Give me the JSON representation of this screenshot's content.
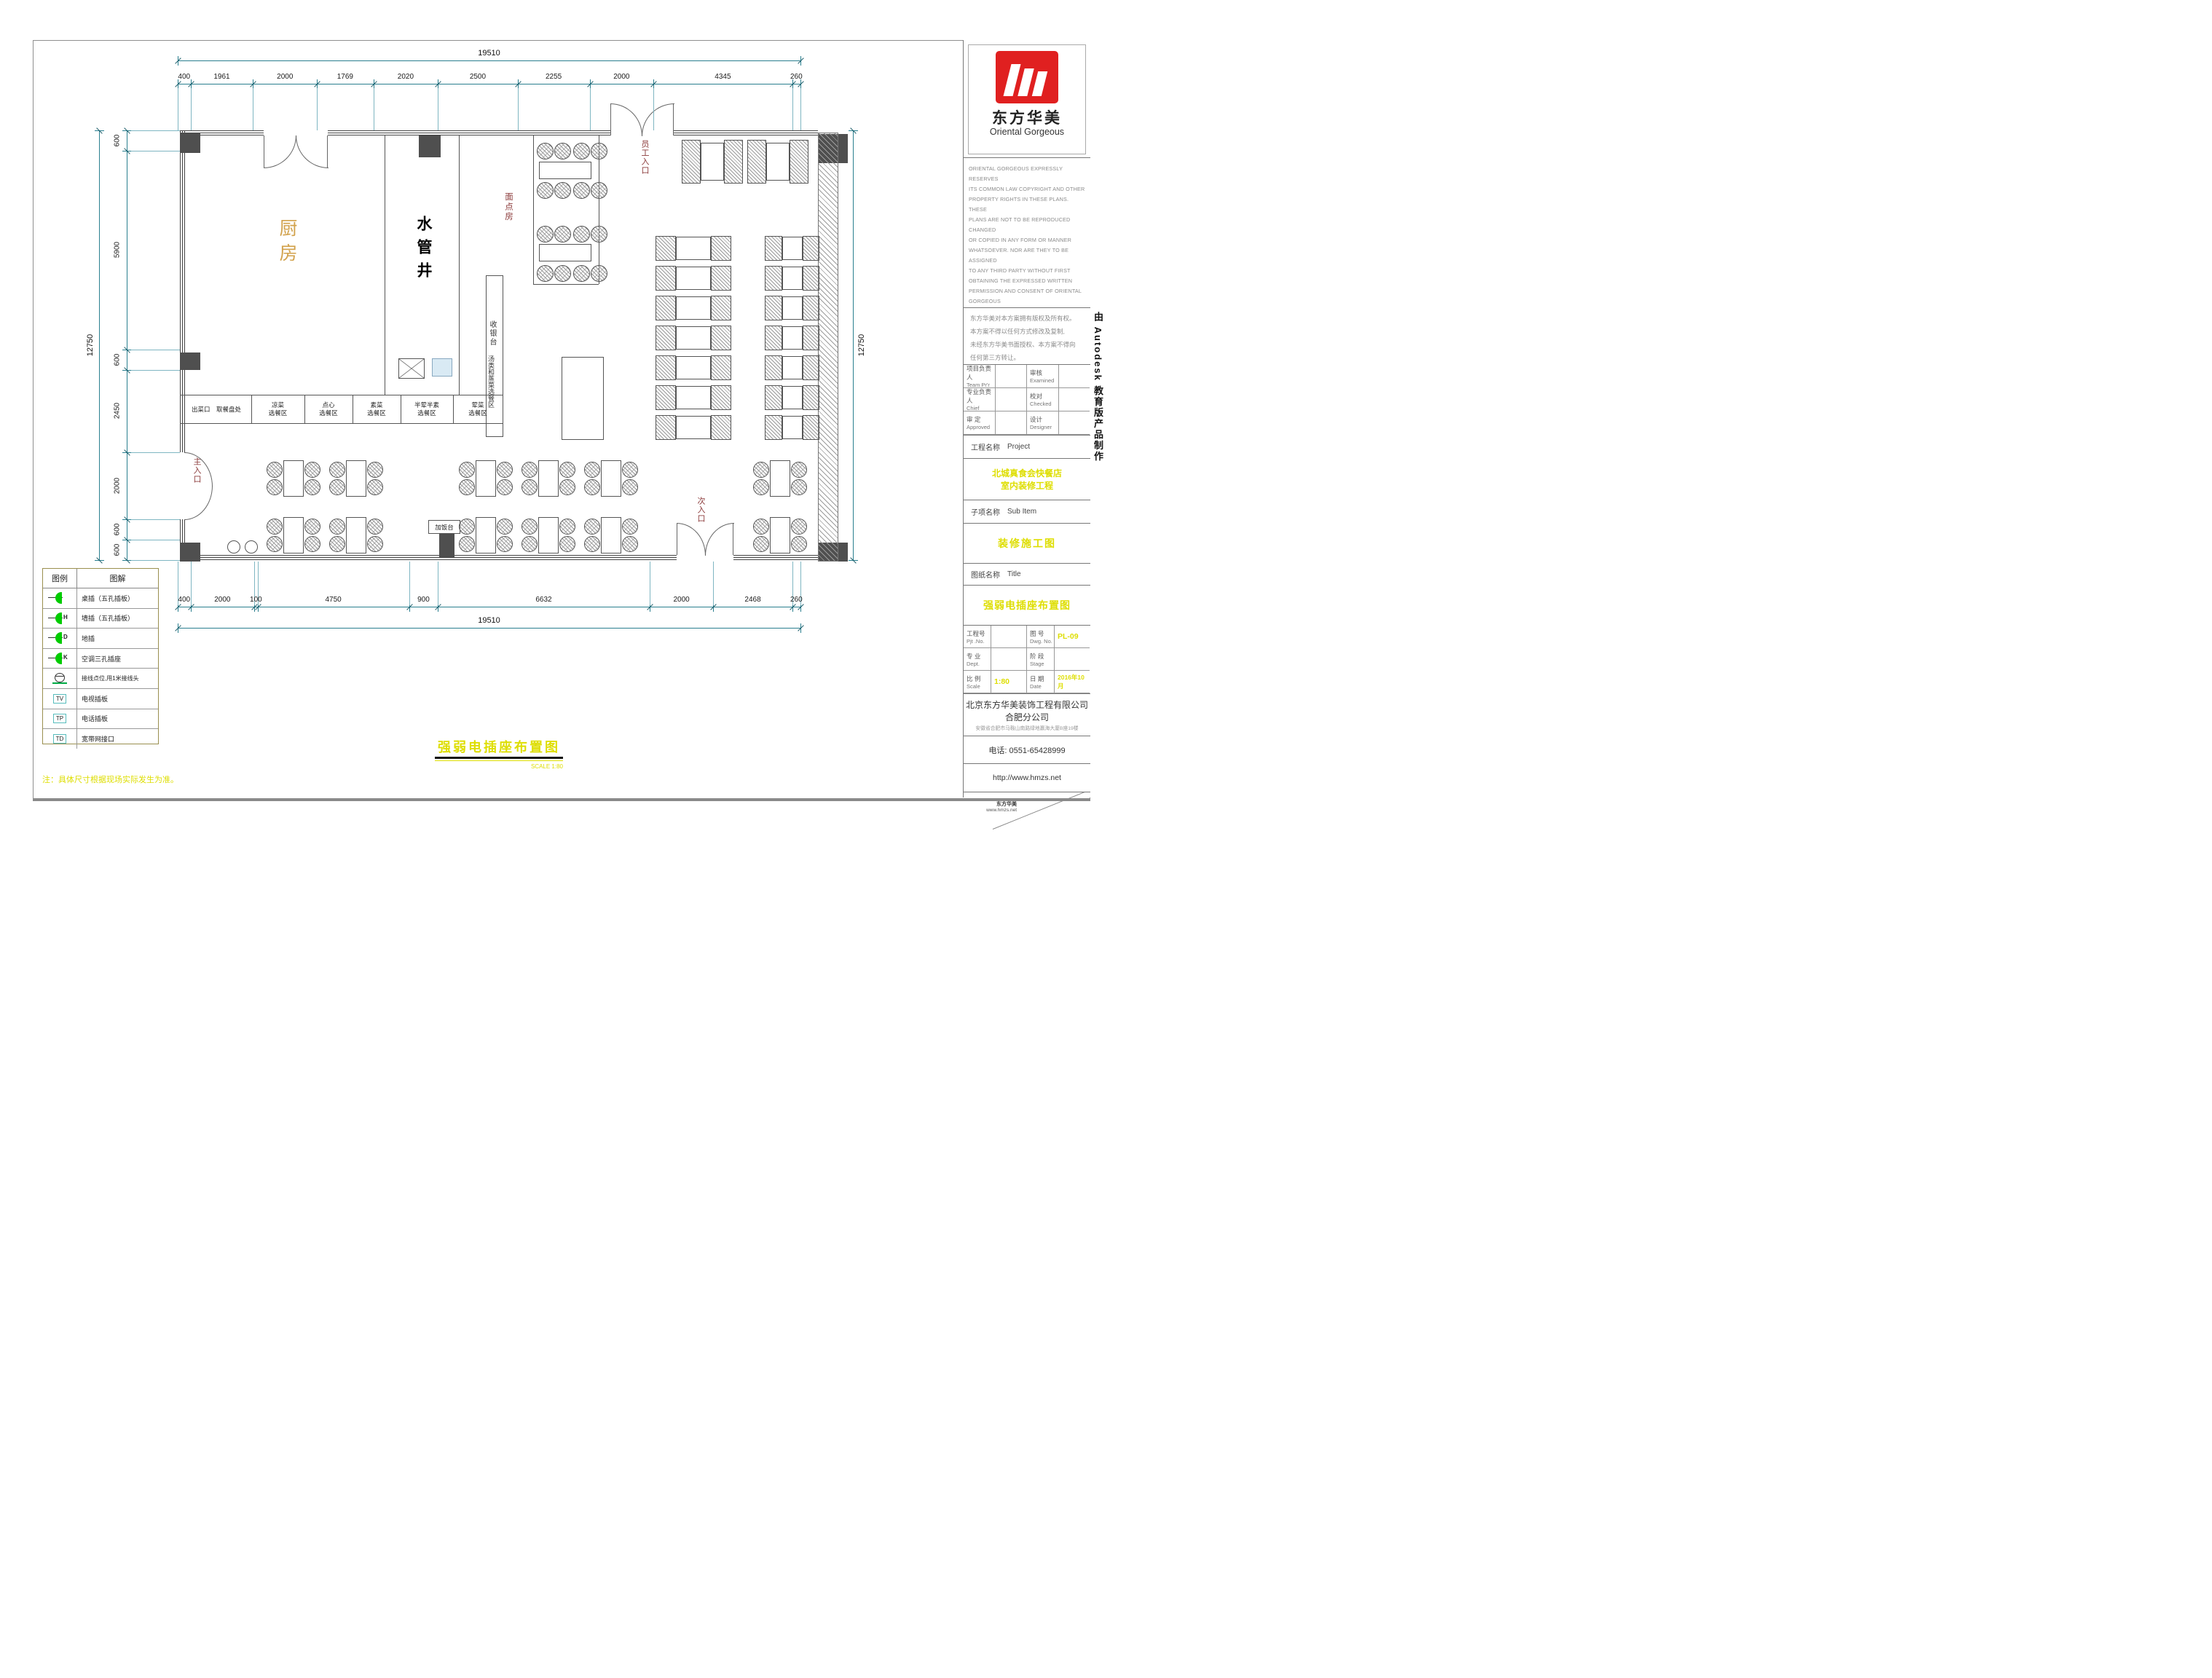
{
  "dimensions": {
    "top": {
      "total": "19510",
      "segments": [
        400,
        1961,
        2000,
        1769,
        2020,
        2500,
        2255,
        2000,
        4345,
        260
      ]
    },
    "bottom": {
      "total": "19510",
      "segments": [
        400,
        2000,
        100,
        4750,
        900,
        6632,
        2000,
        2468,
        260
      ]
    },
    "left": {
      "total": "12750",
      "segments": [
        600,
        5900,
        600,
        2450,
        2000,
        600,
        600
      ]
    },
    "right": {
      "total": "12750"
    }
  },
  "plan": {
    "kitchen": "厨房",
    "pipe_shaft": "水管井",
    "pastry_room": "面点房",
    "staff_entrance": "员工入口",
    "main_entrance": "主入口",
    "secondary_entrance": "次入口",
    "cashier_strip": "收银台",
    "soup_area": "汤类和蒸菜选餐区",
    "cashier_desk": "收银台",
    "desk_box": "加饭台",
    "rice_station": "加饭台",
    "serving_cells": [
      {
        "line1": "出菜口　取餐盘处",
        "line2": ""
      },
      {
        "line1": "凉菜",
        "line2": "选餐区"
      },
      {
        "line1": "点心",
        "line2": "选餐区"
      },
      {
        "line1": "素菜",
        "line2": "选餐区"
      },
      {
        "line1": "半荤半素",
        "line2": "选餐区"
      },
      {
        "line1": "荤菜",
        "line2": "选餐区"
      }
    ]
  },
  "legend": {
    "headers": [
      "图例",
      "图解"
    ],
    "rows": [
      {
        "icon": "plug",
        "mark": "",
        "label": "桌插（五孔插板）"
      },
      {
        "icon": "plug",
        "mark": "H",
        "label": "墙插（五孔插板）"
      },
      {
        "icon": "plug",
        "mark": "D",
        "label": "地插"
      },
      {
        "icon": "plug",
        "mark": "K",
        "label": "空调三孔插座"
      },
      {
        "icon": "junction",
        "mark": "",
        "label": "接线点位,甩1米接线头"
      },
      {
        "icon": "box",
        "mark": "TV",
        "label": "电视插板"
      },
      {
        "icon": "box",
        "mark": "TP",
        "label": "电话插板"
      },
      {
        "icon": "box",
        "mark": "TD",
        "label": "宽带网接口"
      }
    ]
  },
  "titleblock": {
    "logo": {
      "cn": "东方华美",
      "en": "Oriental Gorgeous"
    },
    "copyright_en": [
      "ORIENTAL GORGEOUS EXPRESSLY RESERVES",
      "ITS COMMON LAW COPYRIGHT AND OTHER",
      "PROPERTY RIGHTS IN THESE PLANS. THESE",
      "PLANS ARE NOT TO BE REPRODUCED CHANGED",
      "OR COPIED IN ANY FORM OR MANNER",
      "WHATSOEVER. NOR ARE THEY TO BE ASSIGNED",
      "TO ANY THIRD PARTY WITHOUT FIRST",
      "OBTAINING THE EXPRESSED WRITTEN",
      "PERMISSION AND CONSENT OF ORIENTAL",
      "GORGEOUS"
    ],
    "copyright_cn": [
      "东方华美对本方案拥有版权及所有权。",
      "本方案不得以任何方式修改及复制,",
      "未经东方华美书面授权、本方案不得向",
      "任何第三方转让。"
    ],
    "fields": [
      {
        "cn": "项目负责人",
        "en": "Team Pr'r"
      },
      {
        "cn": "审核",
        "en": "Examined"
      },
      {
        "cn": "专业负责人",
        "en": "Chief"
      },
      {
        "cn": "校对",
        "en": "Checked"
      },
      {
        "cn": "审 定",
        "en": "Approved"
      },
      {
        "cn": "设计",
        "en": "Designer"
      }
    ],
    "project_label": {
      "cn": "工程名称",
      "en": "Project"
    },
    "project_name": [
      "北城真食会快餐店",
      "室内装修工程"
    ],
    "subitem_label": {
      "cn": "子项名称",
      "en": "Sub Item"
    },
    "stage_title": "装修施工图",
    "sheet_label": {
      "cn": "图纸名称",
      "en": "Title"
    },
    "sheet_title": "强弱电插座布置图",
    "info_grid": [
      {
        "cn": "工程号",
        "en": "Pjt .No.",
        "value": ""
      },
      {
        "cn": "图 号",
        "en": "Dwg. No.",
        "value": "PL-09"
      },
      {
        "cn": "专 业",
        "en": "Dept.",
        "value": ""
      },
      {
        "cn": "阶 段",
        "en": "Stage",
        "value": ""
      },
      {
        "cn": "比 例",
        "en": "Scale",
        "value": "1:80"
      },
      {
        "cn": "日 期",
        "en": "Date",
        "value": "2016年10月"
      }
    ],
    "company": [
      "北京东方华美装饰工程有限公司",
      "合肥分公司"
    ],
    "address": "安徽省合肥市马鞍山南路绿地赢海大厦B座19楼",
    "phone": "电话: 0551-65428999",
    "url": "http://www.hmzs.net",
    "autodesk": "由 Autodesk 教育版产品制作"
  },
  "footer": {
    "title": "强弱电插座布置图",
    "scale": "SCALE  1:80",
    "note": "注：具体尺寸根据现场实际发生为准。",
    "print_brand": "东方华美",
    "print_url": "www.hmzs.net"
  },
  "colors": {
    "dimension": "#2a7f8f",
    "accent_yellow": "#dede00",
    "legend_green": "#00cc00",
    "entrance_red": "#8b3a3a",
    "kitchen_label": "#d2a24c",
    "logo_red": "#e02020"
  }
}
